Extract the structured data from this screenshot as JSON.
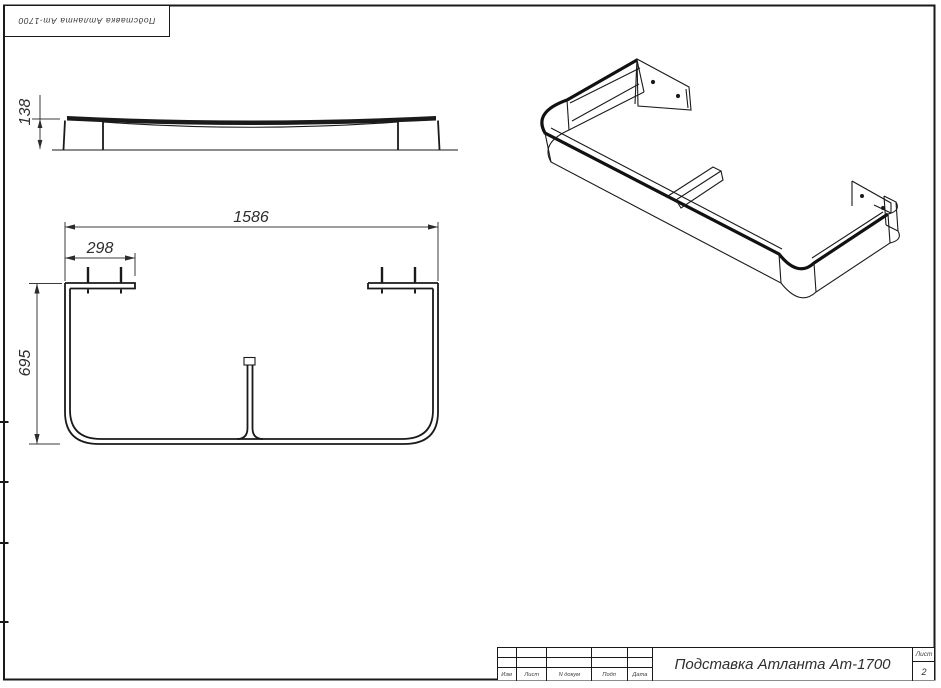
{
  "colors": {
    "line": "#1a1a1a",
    "dim_line": "#3b3b3b",
    "background": "#ffffff"
  },
  "top_stamp": {
    "text": "Подставка Атланта Ат-1700"
  },
  "views": {
    "side": {
      "dim_height": "138"
    },
    "plan": {
      "dim_width": "1586",
      "dim_flange": "298",
      "dim_depth": "695"
    }
  },
  "title_block": {
    "title": "Подставка Атланта Ат-1700",
    "col_izm": "Изм",
    "col_list": "Лист",
    "col_ndokum": "N докум",
    "col_podp": "Подп",
    "col_data": "Дата",
    "sheet_label": "Лист",
    "sheet_number": "2"
  }
}
